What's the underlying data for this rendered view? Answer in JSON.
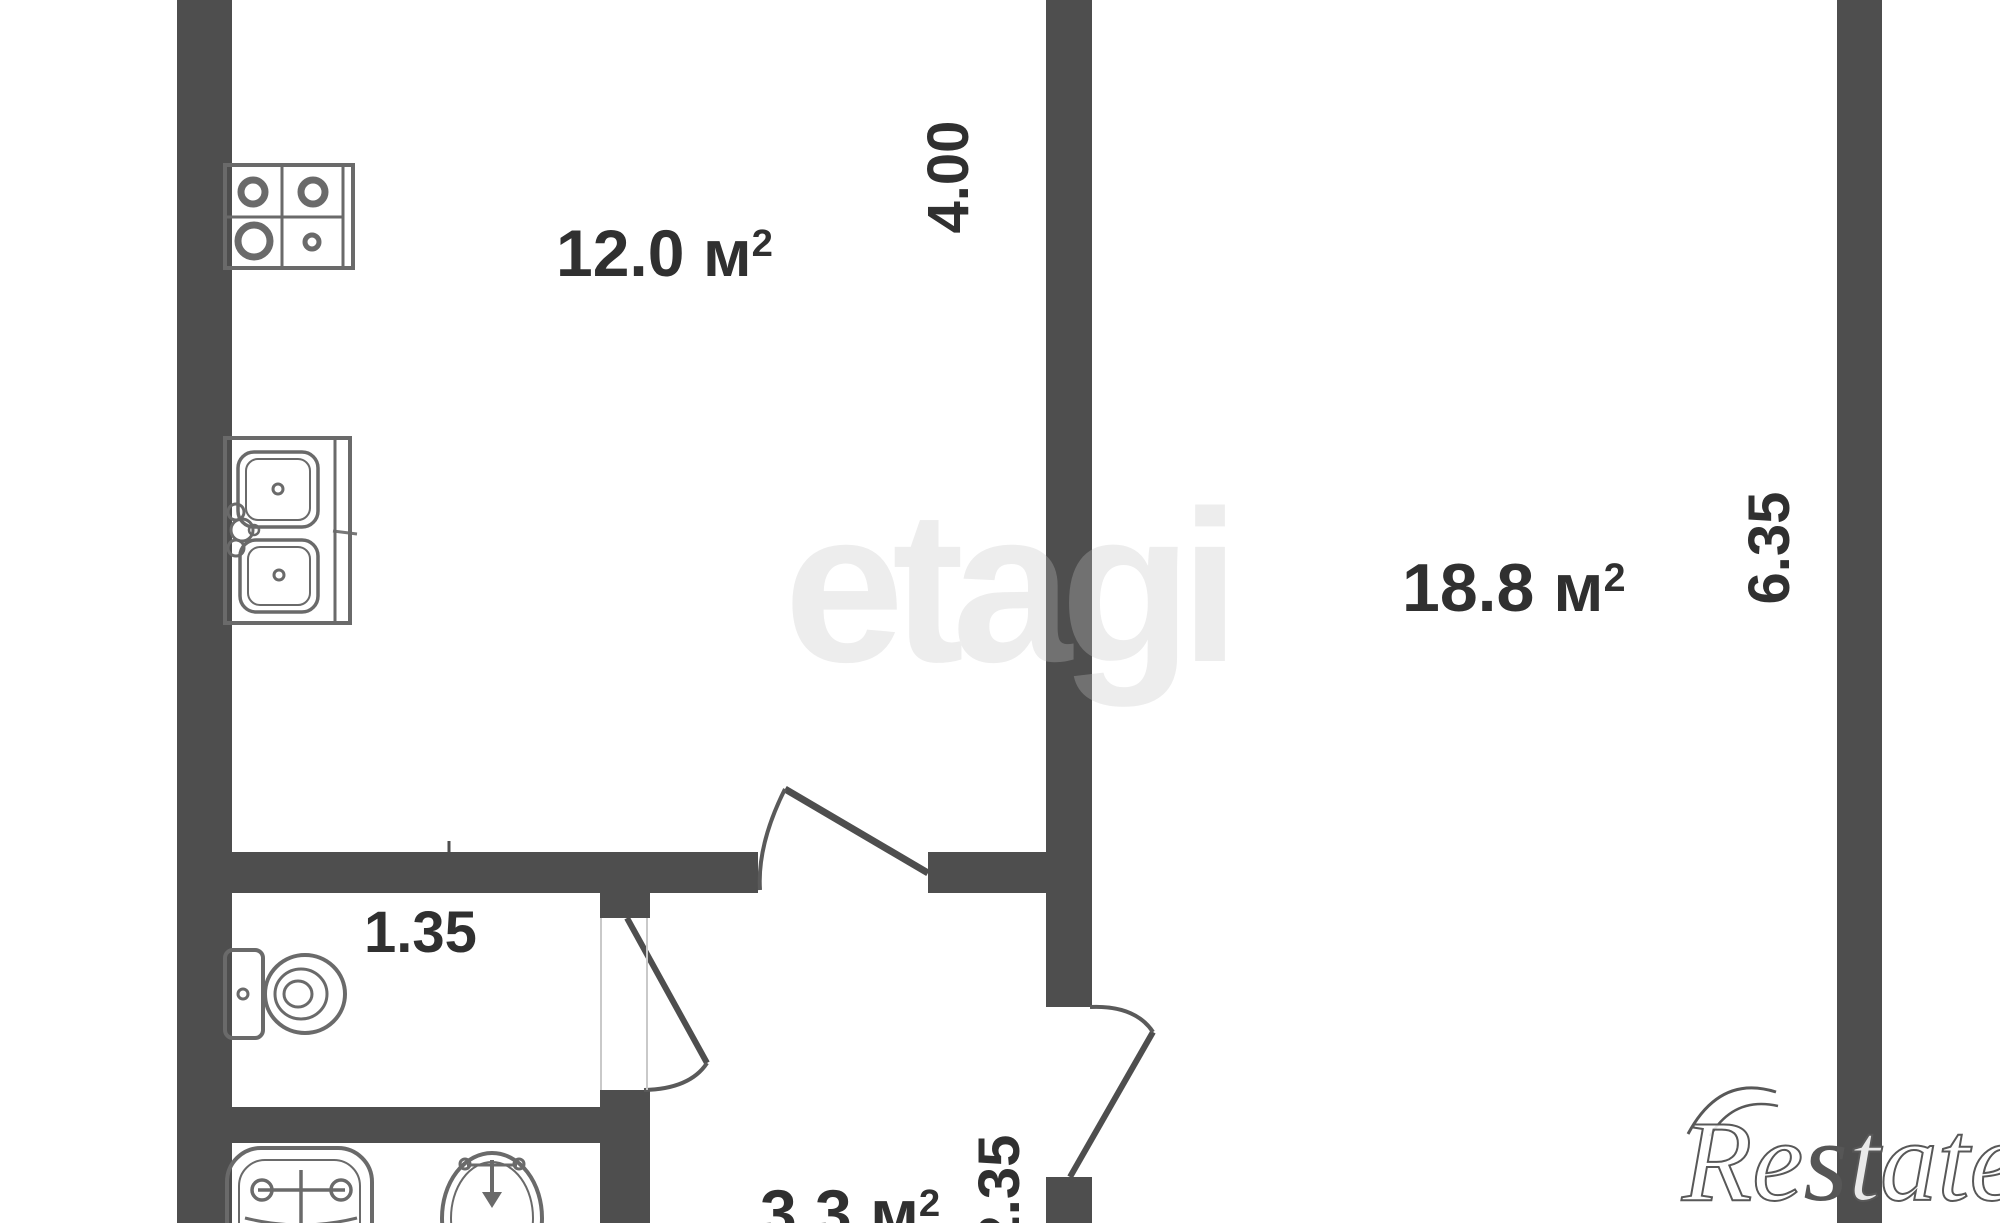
{
  "floorplan": {
    "rooms": {
      "kitchen": {
        "area": "12.0",
        "unit": "м",
        "exp": "2"
      },
      "living": {
        "area": "18.8",
        "unit": "м",
        "exp": "2"
      },
      "hallway": {
        "area": "3.3",
        "unit": "м",
        "exp": "2"
      }
    },
    "dimensions": {
      "kitchen_depth": "4.00",
      "living_depth": "6.35",
      "wc_width": "1.35",
      "hall_width": "2.35"
    },
    "watermarks": {
      "center": "etagi",
      "corner_part1": "Re",
      "corner_part2": "s",
      "corner_part3": "tate"
    },
    "colors": {
      "wall": "#4e4e4e",
      "label": "#303030",
      "fixture_outline": "#6a6a6a",
      "watermark_light": "#e9e9e9",
      "watermark_outline": "#585858"
    }
  }
}
